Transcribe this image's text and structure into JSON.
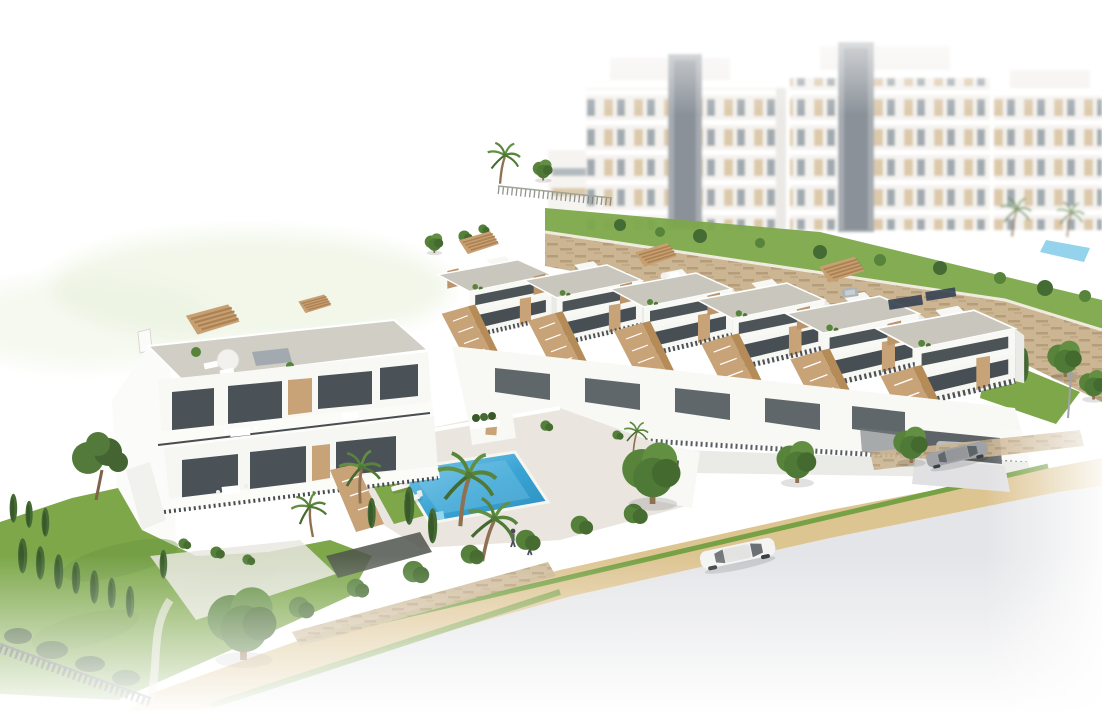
{
  "scene": {
    "type": "architectural-render",
    "description": "Aerial 3D render of a modern white residential development: a terraced row of six townhouses with roof terraces and external stairs, a twin villa block, a communal swimming pool with sun loungers and parasols, landscaped gardens, a sand-coloured footpath, a street with cars, and hazy apartment blocks in the background fading to white.",
    "palette": {
      "background": "#ffffff",
      "haze_green": "#e9f1da",
      "building_white": "#f8f8f5",
      "building_shadow": "#e9e9e5",
      "roof_gravel": "#c6c3ba",
      "glass_dark": "#414950",
      "railing_dark": "#3f4448",
      "accent_tan": "#c79f71",
      "accent_tan_dark": "#ab7f4f",
      "stone_wall": "#c9b28d",
      "stone_wall_dark": "#b19872",
      "lawn_green": "#76a340",
      "lawn_dark": "#648c34",
      "tree_green": "#4e7d31",
      "tree_light": "#5a8a38",
      "cypress_green": "#3c642a",
      "pool_blue": "#2e9ed2",
      "pool_blue_light": "#7cc8e8",
      "path_sand": "#dcc28c",
      "path_sand_dark": "#c9ab72",
      "road_gray": "#e3e4e7",
      "driveway_gray": "#e0e0e2",
      "car_white": "#f4f4f3",
      "car_gray": "#9b9ea2",
      "garage_dark": "#565b60",
      "apartment_beige": "#d9c3a1",
      "apartment_window_gray": "#97a0a7",
      "trunk_brown": "#8a6a48",
      "parasol_tan": "#b68a58",
      "solar_panel": "#2f3b4c",
      "people_dark": "#3f4449"
    },
    "objects": [
      {
        "name": "background-apartments",
        "count": 3,
        "note": "hazy multi-storey white blocks with beige panels and grey lift towers"
      },
      {
        "name": "townhouse-row",
        "count": 6,
        "note": "white terraced homes, tan stair parapets, gravel flat roofs, dark glazing"
      },
      {
        "name": "villa-left",
        "count": 1,
        "note": "twin two-storey villa with roof terrace, tan pergolas and balconies"
      },
      {
        "name": "swimming-pool",
        "count": 1,
        "note": "rotated rectangular azure pool on pale deck"
      },
      {
        "name": "parasol",
        "count": 2
      },
      {
        "name": "sun-lounger",
        "count": 8
      },
      {
        "name": "pedestrian",
        "count": 2
      },
      {
        "name": "white-car",
        "count": 1
      },
      {
        "name": "gray-car",
        "count": 1
      },
      {
        "name": "stone-retaining-wall",
        "count": 2
      },
      {
        "name": "palm-tree",
        "count": 7
      },
      {
        "name": "cypress-tree",
        "count": 14
      },
      {
        "name": "round-tree",
        "count": 8
      },
      {
        "name": "footpath-sand",
        "count": 1
      },
      {
        "name": "street-road",
        "count": 1
      }
    ]
  }
}
